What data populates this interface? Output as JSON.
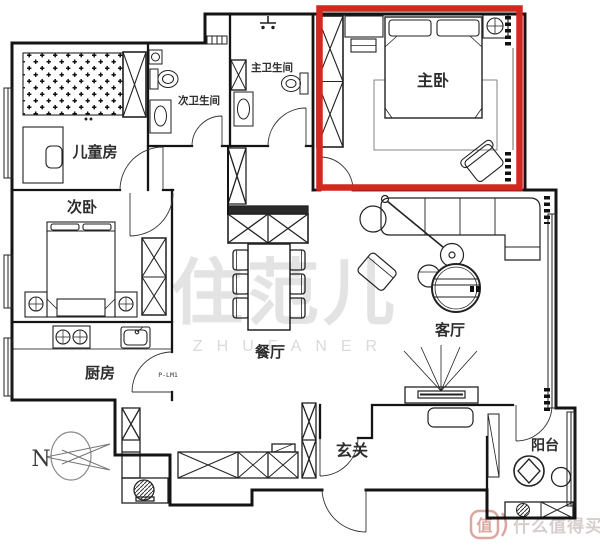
{
  "rooms": {
    "children": "儿童房",
    "second_bedroom": "次卧",
    "kitchen": "厨房",
    "second_bathroom": "次卫生间",
    "master_bathroom": "主卫生间",
    "master_bedroom": "主卧",
    "dining": "餐厅",
    "living": "客厅",
    "entry": "玄关",
    "balcony": "阳台"
  },
  "annotations": {
    "door_code": "P-LM1",
    "north_label": "N"
  },
  "highlight": {
    "room": "master_bedroom",
    "color": "#d2281e"
  },
  "watermarks": {
    "center_hanzi": "住范儿",
    "center_latin": "ZHUFANER",
    "corner_logo": "值",
    "corner_text": "什么值得买"
  }
}
